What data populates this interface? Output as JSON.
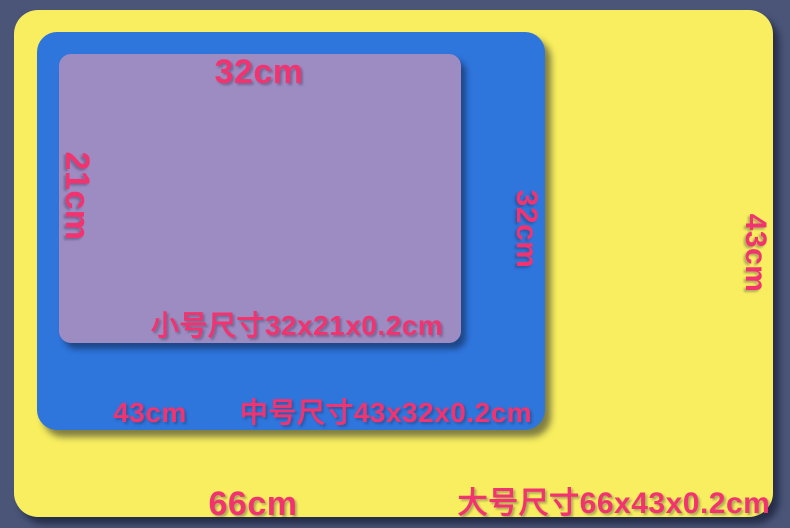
{
  "colors": {
    "background": "#4a5578",
    "large_pad": "#f8ee5f",
    "medium_pad": "#2e75dc",
    "small_pad": "#9d8cc2",
    "label_text": "#f2336f"
  },
  "pads": {
    "large": {
      "size_caption": "大号尺寸66x43x0.2cm",
      "bottom_width_label": "66cm",
      "right_height_label": "43cm"
    },
    "medium": {
      "size_caption": "中号尺寸43x32x0.2cm",
      "bottom_width_label": "43cm",
      "right_height_label": "32cm"
    },
    "small": {
      "size_caption": "小号尺寸32x21x0.2cm",
      "top_width_label": "32cm",
      "left_height_label": "21cm"
    }
  }
}
